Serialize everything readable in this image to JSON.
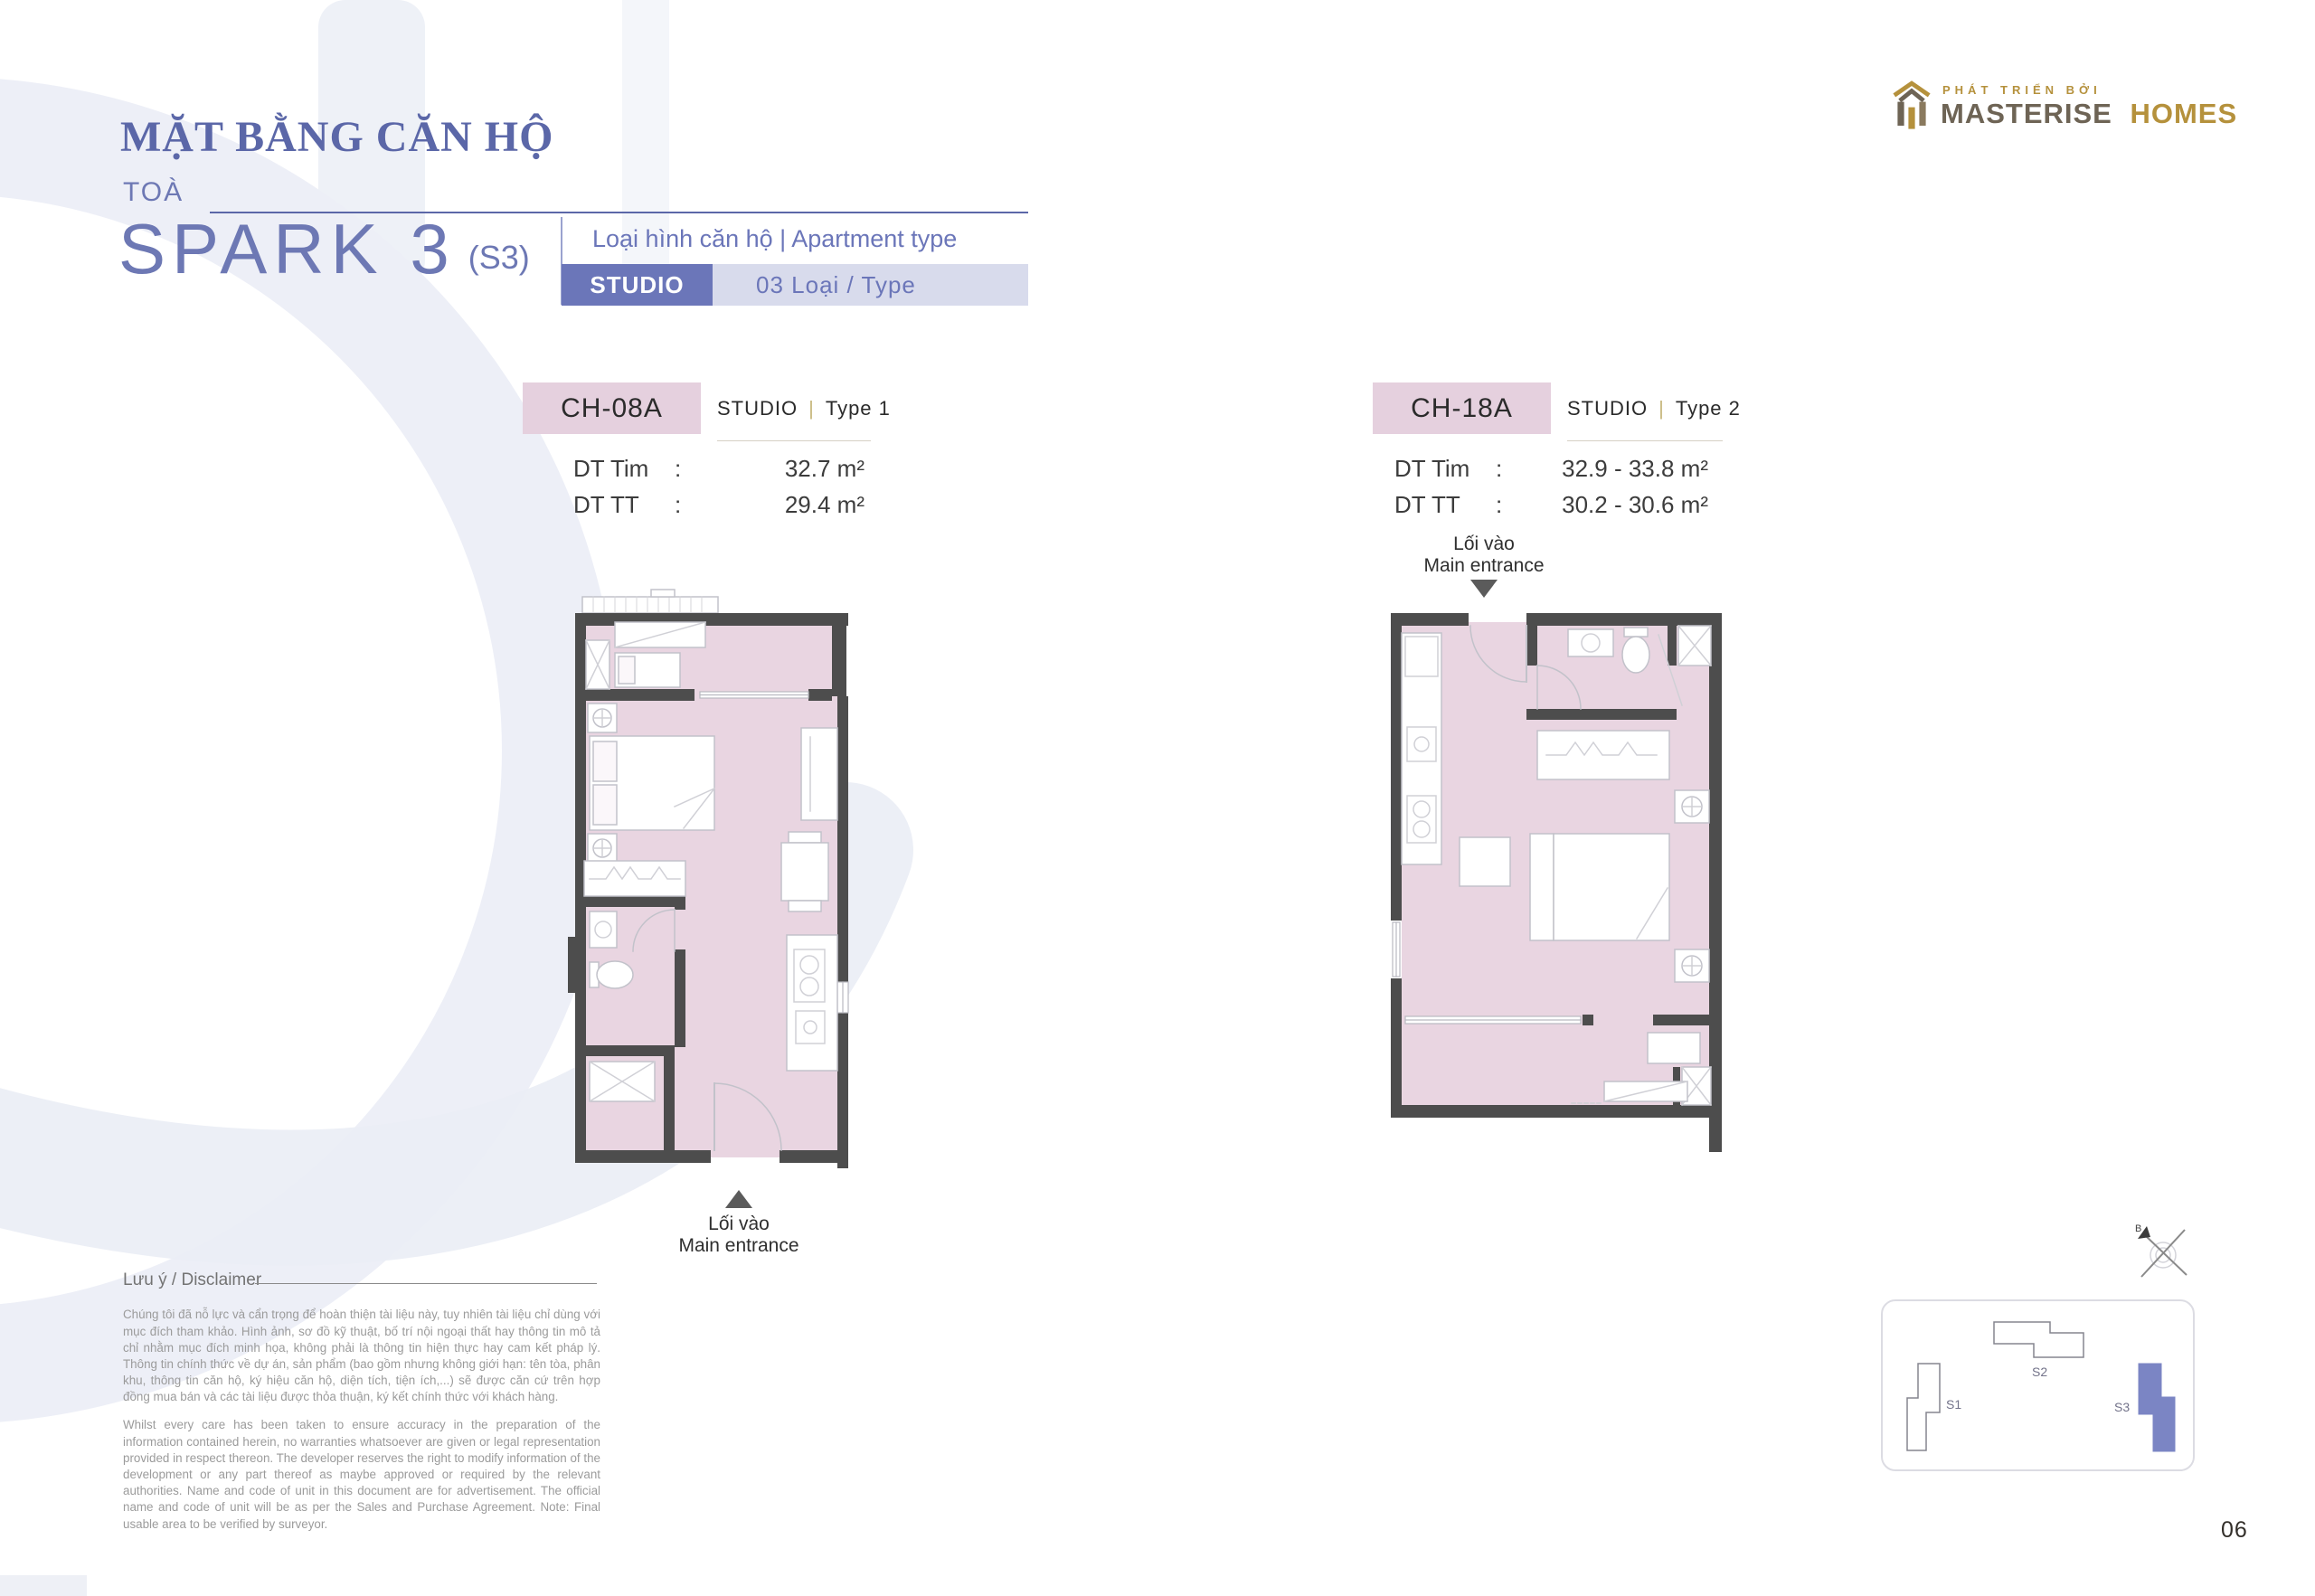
{
  "page": {
    "title": "MẶT BẰNG CĂN HỘ",
    "building_label": "TOÀ",
    "building_name": "SPARK 3",
    "building_code": "(S3)",
    "page_number": "06"
  },
  "developer": {
    "tagline": "PHÁT TRIỂN BỞI",
    "name_primary": "MASTERISE",
    "name_secondary": "HOMES"
  },
  "apartment_type": {
    "label": "Loại hình căn hộ | Apartment type",
    "type": "STUDIO",
    "count": "03 Loại / Type"
  },
  "shared": {
    "separator": "|",
    "colon": ":"
  },
  "units": [
    {
      "code": "CH-08A",
      "type": "STUDIO",
      "variant": "Type 1",
      "areas": [
        {
          "label": "DT Tim",
          "value": "32.7 m²"
        },
        {
          "label": "DT TT",
          "value": "29.4 m²"
        }
      ],
      "entrance": {
        "line1": "Lối vào",
        "line2": "Main entrance",
        "position": "bottom"
      }
    },
    {
      "code": "CH-18A",
      "type": "STUDIO",
      "variant": "Type 2",
      "areas": [
        {
          "label": "DT Tim",
          "value": "32.9 - 33.8 m²"
        },
        {
          "label": "DT TT",
          "value": "30.2 - 30.6 m²"
        }
      ],
      "entrance": {
        "line1": "Lối vào",
        "line2": "Main entrance",
        "position": "top"
      }
    }
  ],
  "disclaimer": {
    "heading": "Lưu ý / Disclaimer",
    "vi": "Chúng tôi đã nỗ lực và cẩn trọng để hoàn thiện tài liệu này, tuy nhiên tài liệu chỉ dùng với mục đích tham khảo. Hình ảnh, sơ đồ kỹ thuật, bố trí nội ngoại thất hay thông tin mô tả chỉ nhằm mục đích minh họa, không phải là thông tin hiện thực hay cam kết pháp lý. Thông tin chính thức về dự án, sản phẩm (bao gồm nhưng không giới hạn: tên tòa, phân khu, thông tin căn hộ, ký hiệu căn hộ, diện tích, tiện ích,...) sẽ được căn cứ trên hợp đồng mua bán và các tài liệu được thỏa thuận, ký kết chính thức với khách hàng.",
    "en": "Whilst every care has been taken to ensure accuracy in the preparation of the information contained herein, no warranties whatsoever are given or legal representation provided in respect thereon. The developer reserves the right to modify information of the development or any part thereof as maybe approved or required by the relevant authorities. Name and code of unit in this document are for advertisement. The official name and code of unit will be as per the Sales and Purchase Agreement. Note: Final usable area to be verified by surveyor."
  },
  "site_map": {
    "compass_label": "B",
    "buildings": [
      {
        "code": "S1",
        "highlighted": false
      },
      {
        "code": "S2",
        "highlighted": false
      },
      {
        "code": "S3",
        "highlighted": true
      }
    ]
  },
  "colors": {
    "accent_purple": "#5b67a8",
    "badge_purple": "#6b76b9",
    "chip_lavender": "#d8dbec",
    "unit_pink": "#e5d0de",
    "plan_pink": "#e9d5e1",
    "wall_gray": "#4d4d4d",
    "gold": "#b5913c",
    "taupe": "#6e6455",
    "s3_fill": "#7b85c4"
  }
}
